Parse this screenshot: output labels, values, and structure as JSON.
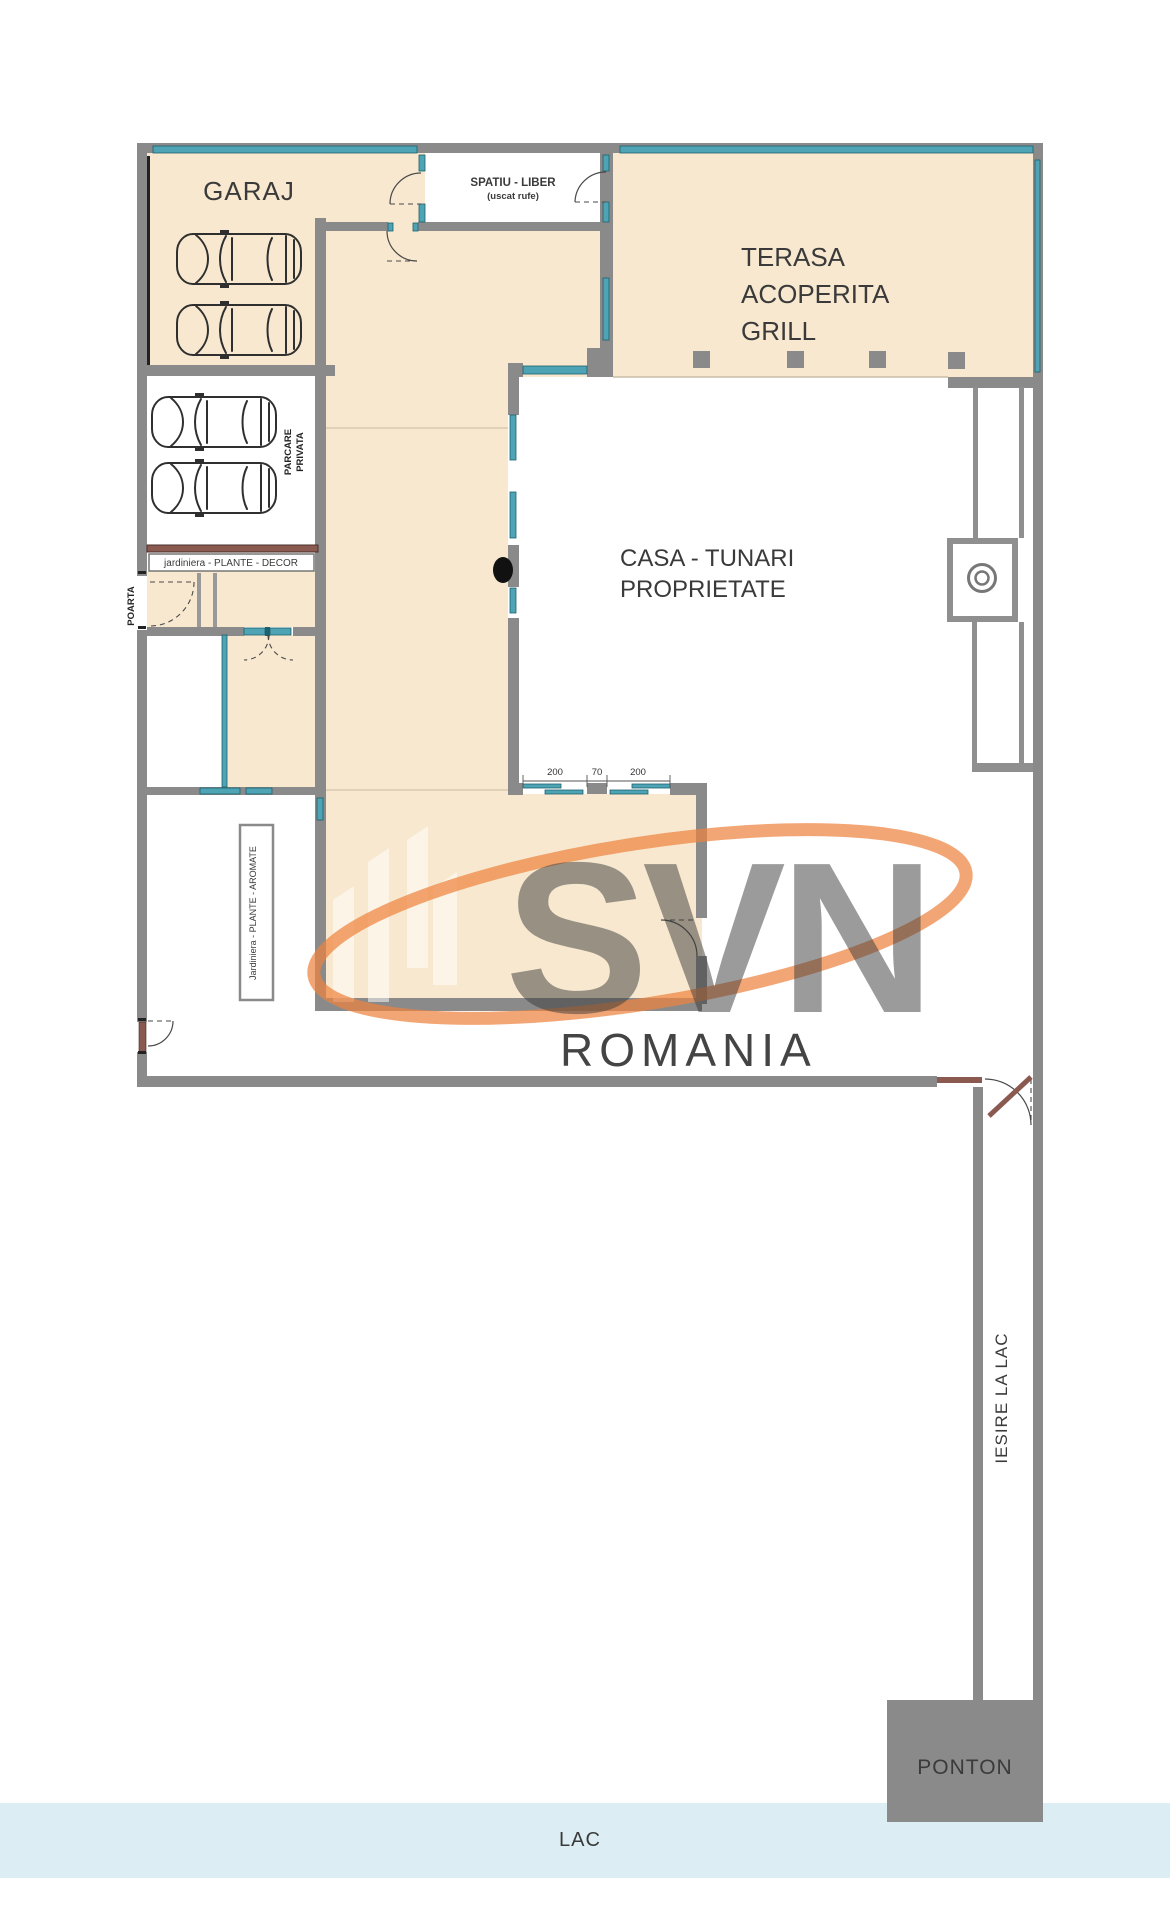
{
  "colors": {
    "beige": "#f7e8cf",
    "wall": "#8a8a8a",
    "wallLight": "#8f8f8f",
    "teal": "#4ea4b5",
    "tealDark": "#1e616e",
    "brown": "#8a5a50",
    "lake": "#dceef4",
    "ink": "#3a3a3a",
    "orange": "#ef8440",
    "salmon": "#f49b79"
  },
  "labels": {
    "garage": "GARAJ",
    "laundry": [
      "SPATIU - LIBER",
      "(uscat rufe)"
    ],
    "terrace": [
      "TERASA",
      "ACOPERITA",
      "GRILL"
    ],
    "property": [
      "CASA - TUNARI",
      "PROPRIETATE"
    ],
    "parking": [
      "PARCARE",
      "PRIVATA"
    ],
    "gate": "POARTA",
    "planter_decor": "jardiniera - PLANTE - DECOR",
    "planter_aromatic": "Jardiniera - PLANTE - AROMATE",
    "lake_exit": "IESIRE LA LAC",
    "pontoon": "PONTON",
    "lake": "LAC"
  },
  "dims": [
    "200",
    "70",
    "200"
  ],
  "watermark": {
    "logo": "SVN",
    "brand": "ROMANIA"
  }
}
